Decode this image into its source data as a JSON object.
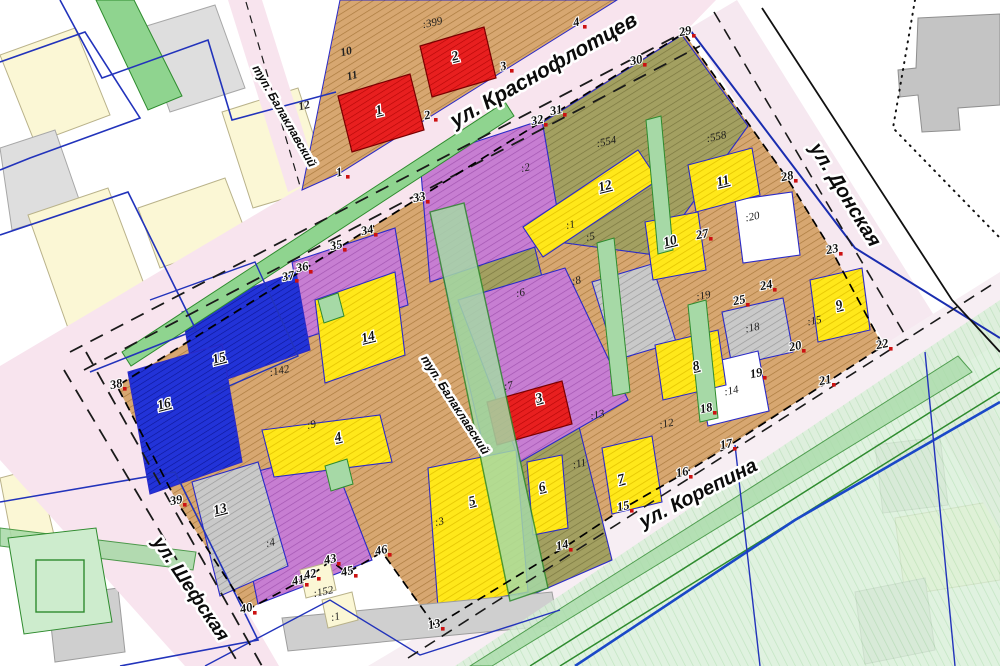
{
  "map": {
    "streets": [
      {
        "name": "ул. Краснофлотцев",
        "x": 547,
        "y": 76,
        "rotate": -29.5,
        "size": 21
      },
      {
        "name": "ул. Донская",
        "x": 840,
        "y": 198,
        "rotate": 58.5,
        "size": 20
      },
      {
        "name": "ул. Шефская",
        "x": 186,
        "y": 592,
        "rotate": 56,
        "size": 19
      },
      {
        "name": "ул. Корепина",
        "x": 701,
        "y": 499,
        "rotate": -27,
        "size": 20
      },
      {
        "name": "туп. Балаклавский",
        "x": 281,
        "y": 118,
        "rotate": 60,
        "size": 12
      },
      {
        "name": "туп. Балаклавский",
        "x": 452,
        "y": 407,
        "rotate": 57,
        "size": 12
      }
    ],
    "plot_numbers": [
      {
        "n": "1",
        "x": 380,
        "y": 114
      },
      {
        "n": "2",
        "x": 456,
        "y": 60
      },
      {
        "n": "3",
        "x": 540,
        "y": 402
      },
      {
        "n": "4",
        "x": 339,
        "y": 441
      },
      {
        "n": "5",
        "x": 473,
        "y": 505
      },
      {
        "n": "6",
        "x": 543,
        "y": 491
      },
      {
        "n": "7",
        "x": 622,
        "y": 483
      },
      {
        "n": "8",
        "x": 697,
        "y": 370
      },
      {
        "n": "9",
        "x": 840,
        "y": 309
      },
      {
        "n": "10",
        "x": 671,
        "y": 245
      },
      {
        "n": "11",
        "x": 724,
        "y": 185
      },
      {
        "n": "12",
        "x": 606,
        "y": 190
      },
      {
        "n": "13",
        "x": 221,
        "y": 513
      },
      {
        "n": "14",
        "x": 369,
        "y": 341
      },
      {
        "n": "15",
        "x": 220,
        "y": 362
      },
      {
        "n": "16",
        "x": 165,
        "y": 408
      }
    ],
    "parcel_ids": [
      {
        "id": ":399",
        "x": 433,
        "y": 26
      },
      {
        "id": ":554",
        "x": 607,
        "y": 145
      },
      {
        "id": ":558",
        "x": 717,
        "y": 140
      },
      {
        "id": ":20",
        "x": 753,
        "y": 220
      },
      {
        "id": ":19",
        "x": 704,
        "y": 299
      },
      {
        "id": ":15",
        "x": 815,
        "y": 324
      },
      {
        "id": ":18",
        "x": 753,
        "y": 331
      },
      {
        "id": ":14",
        "x": 732,
        "y": 394
      },
      {
        "id": ":2",
        "x": 526,
        "y": 171
      },
      {
        "id": ":1",
        "x": 571,
        "y": 228
      },
      {
        "id": ":5",
        "x": 591,
        "y": 240
      },
      {
        "id": ":8",
        "x": 577,
        "y": 284
      },
      {
        "id": ":6",
        "x": 521,
        "y": 296
      },
      {
        "id": ":7",
        "x": 509,
        "y": 389
      },
      {
        "id": ":13",
        "x": 598,
        "y": 418
      },
      {
        "id": ":12",
        "x": 667,
        "y": 427
      },
      {
        "id": ":11",
        "x": 580,
        "y": 467
      },
      {
        "id": ":3",
        "x": 440,
        "y": 525
      },
      {
        "id": ":9",
        "x": 312,
        "y": 428
      },
      {
        "id": ":142",
        "x": 280,
        "y": 374
      },
      {
        "id": ":4",
        "x": 271,
        "y": 546
      },
      {
        "id": ":152",
        "x": 324,
        "y": 595
      },
      {
        "id": ":1",
        "x": 336,
        "y": 620
      }
    ],
    "boundary_points": [
      {
        "n": "1",
        "x": 340,
        "y": 176
      },
      {
        "n": "2",
        "x": 428,
        "y": 119
      },
      {
        "n": "3",
        "x": 504,
        "y": 70
      },
      {
        "n": "4",
        "x": 577,
        "y": 26
      },
      {
        "n": "29",
        "x": 686,
        "y": 35
      },
      {
        "n": "30",
        "x": 637,
        "y": 64
      },
      {
        "n": "31",
        "x": 557,
        "y": 114
      },
      {
        "n": "32",
        "x": 538,
        "y": 124
      },
      {
        "n": "33",
        "x": 420,
        "y": 201
      },
      {
        "n": "34",
        "x": 368,
        "y": 234
      },
      {
        "n": "35",
        "x": 337,
        "y": 249
      },
      {
        "n": "36",
        "x": 303,
        "y": 271
      },
      {
        "n": "37",
        "x": 289,
        "y": 280
      },
      {
        "n": "38",
        "x": 117,
        "y": 388
      },
      {
        "n": "39",
        "x": 177,
        "y": 504
      },
      {
        "n": "40",
        "x": 247,
        "y": 612
      },
      {
        "n": "41",
        "x": 299,
        "y": 584
      },
      {
        "n": "42",
        "x": 311,
        "y": 578
      },
      {
        "n": "43",
        "x": 331,
        "y": 563
      },
      {
        "n": "45",
        "x": 348,
        "y": 575
      },
      {
        "n": "46",
        "x": 382,
        "y": 554
      },
      {
        "n": "13",
        "x": 435,
        "y": 628
      },
      {
        "n": "14",
        "x": 563,
        "y": 549
      },
      {
        "n": "15",
        "x": 624,
        "y": 510
      },
      {
        "n": "16",
        "x": 683,
        "y": 476
      },
      {
        "n": "17",
        "x": 727,
        "y": 448
      },
      {
        "n": "18",
        "x": 707,
        "y": 412
      },
      {
        "n": "19",
        "x": 757,
        "y": 377
      },
      {
        "n": "20",
        "x": 796,
        "y": 350
      },
      {
        "n": "21",
        "x": 826,
        "y": 384
      },
      {
        "n": "22",
        "x": 883,
        "y": 348
      },
      {
        "n": "23",
        "x": 833,
        "y": 253
      },
      {
        "n": "24",
        "x": 767,
        "y": 289
      },
      {
        "n": "25",
        "x": 740,
        "y": 304
      },
      {
        "n": "27",
        "x": 703,
        "y": 238
      },
      {
        "n": "28",
        "x": 788,
        "y": 180
      }
    ],
    "house_numbers": [
      {
        "n": "10",
        "x": 347,
        "y": 55
      },
      {
        "n": "11",
        "x": 353,
        "y": 79
      },
      {
        "n": "12",
        "x": 305,
        "y": 109
      }
    ],
    "colors": {
      "road_pink": "#f8e4ee",
      "parcel_tan": "#d7a771",
      "parcel_olive": "#a3a061",
      "parcel_purple": "#c77ed2",
      "plot_yellow": "#ffe81a",
      "building_red": "#e81f1f",
      "plot_blue": "#2233d8",
      "parcel_gray": "#c9c9c9",
      "green_zone": "#8fce8f",
      "boundary_dash": "#000000",
      "vertex_red": "#cc1111",
      "utility_blue": "#2233bb"
    }
  }
}
